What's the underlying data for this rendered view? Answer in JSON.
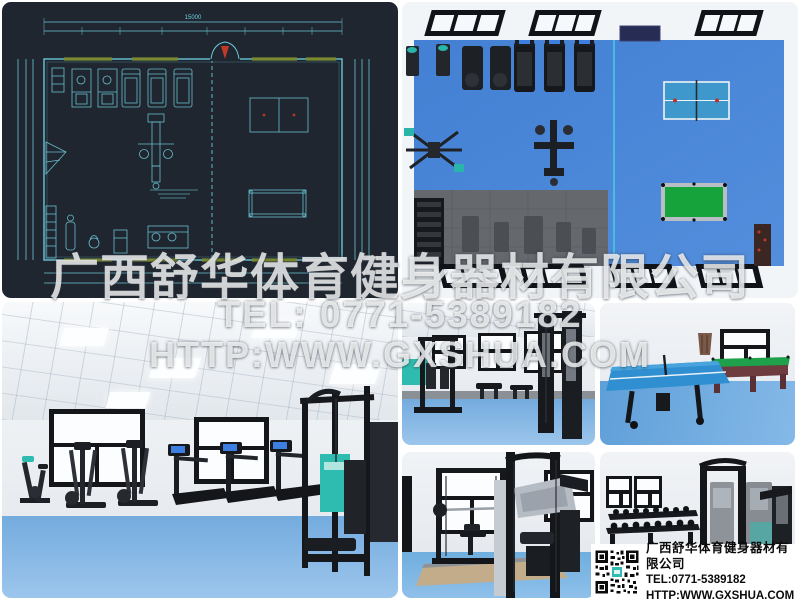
{
  "watermark": {
    "company": "广西舒华体育健身器材有限公司",
    "tel": "TEL: 0771-5389182",
    "url": "HTTP:WWW.GXSHUA.COM"
  },
  "info_box": {
    "company": "广西舒华体育健身器材有限公司",
    "tel": "TEL:0771-5389182",
    "url": "HTTP:WWW.GXSHUA.COM"
  },
  "cad": {
    "dim_top": "15000"
  },
  "icons": {
    "qr_code": "qr-grid-pattern"
  },
  "colors": {
    "cad_background": "#20262f",
    "cad_line": "#6ecfe0",
    "cad_window_olive": "#7a8a30",
    "cad_door_red": "#c0392b",
    "floor_blue_topview": "#4a86d8",
    "floor_blue_interior": "#8cbce8",
    "mat_gray": "#696c71",
    "table_tennis_blue": "#3f98cc",
    "pool_table_green": "#17a33c",
    "equipment_teal": "#2fbcb0",
    "frame_black": "#15171b"
  }
}
